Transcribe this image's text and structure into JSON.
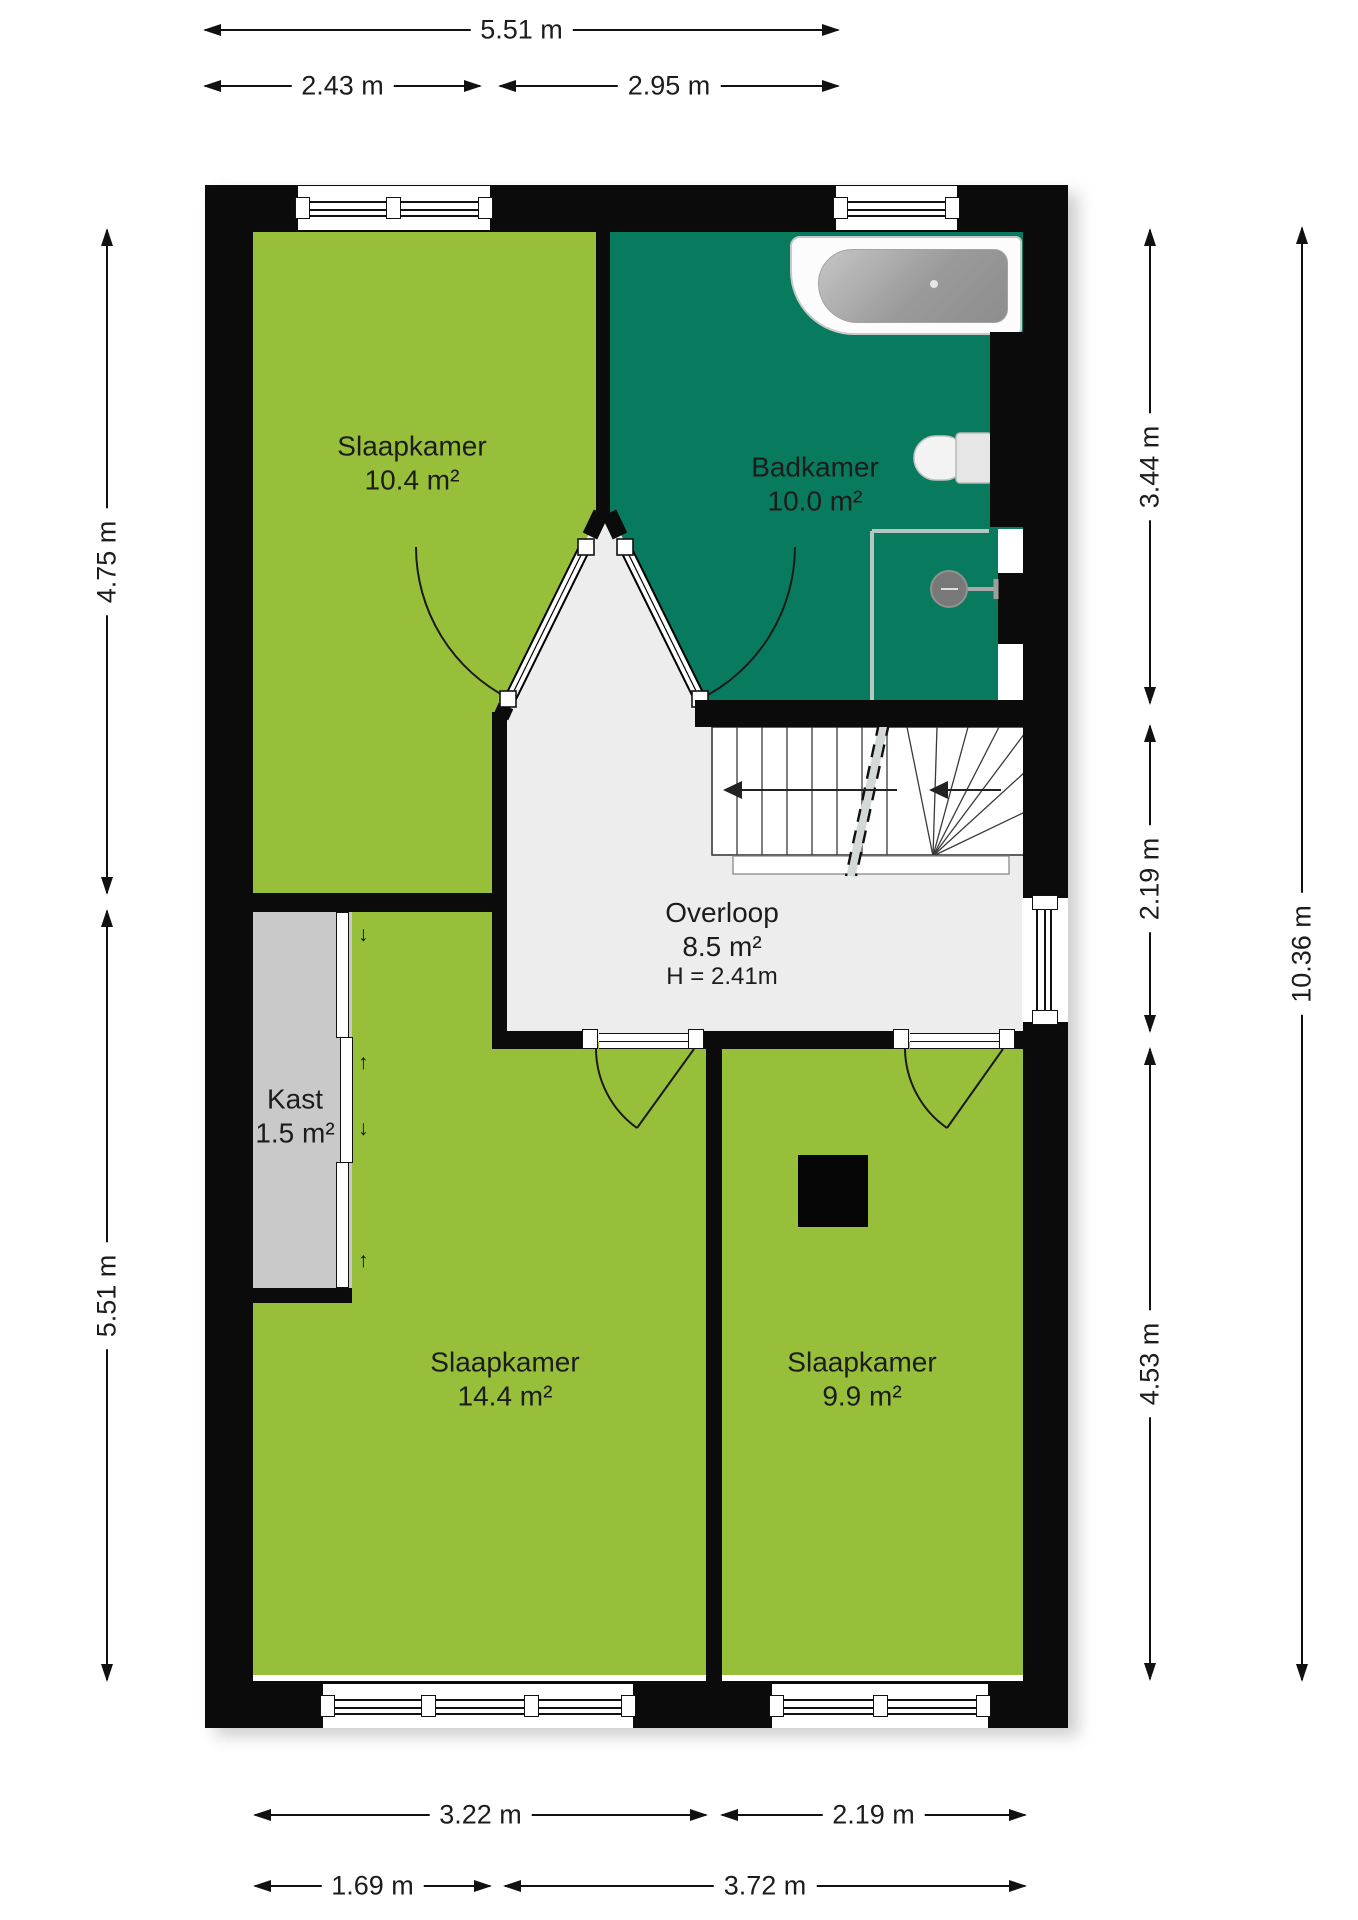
{
  "plan": {
    "type": "floor-plan",
    "floor_label": "upper floor"
  },
  "rooms": {
    "slaapkamer1": {
      "name": "Slaapkamer",
      "area": "10.4 m²"
    },
    "badkamer": {
      "name": "Badkamer",
      "area": "10.0 m²"
    },
    "overloop": {
      "name": "Overloop",
      "area": "8.5 m²",
      "ceiling_height": "H = 2.41m"
    },
    "kast": {
      "name": "Kast",
      "area": "1.5 m²"
    },
    "slaapkamer2": {
      "name": "Slaapkamer",
      "area": "14.4 m²"
    },
    "slaapkamer3": {
      "name": "Slaapkamer",
      "area": "9.9 m²"
    }
  },
  "dimensions": {
    "top": [
      "5.51 m",
      "2.43 m",
      "2.95 m"
    ],
    "left": [
      "4.75 m",
      "5.51 m"
    ],
    "right": [
      "3.44 m",
      "2.19 m",
      "4.53 m",
      "10.36 m"
    ],
    "bottom": [
      "3.22 m",
      "2.19 m",
      "1.69 m",
      "3.72 m"
    ]
  },
  "colors": {
    "room_green": "#98bf3a",
    "bathroom_teal": "#087a5e",
    "closet_gray": "#c9c9c9",
    "landing_gray": "#ededed",
    "wall_black": "#0b0b0b",
    "background": "#ffffff"
  }
}
